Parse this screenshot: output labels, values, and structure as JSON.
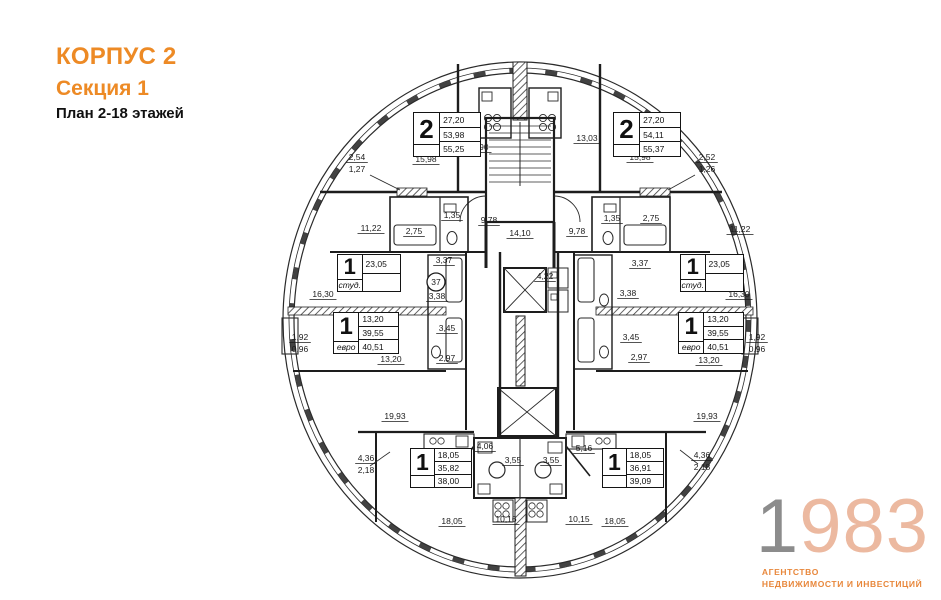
{
  "title": {
    "building": "КОРПУС 2",
    "section": "Секция 1",
    "plan": "План 2-18 этажей"
  },
  "logo": {
    "digit_first": "1",
    "digits_rest": "983",
    "agency_line1": "АГЕНТСТВО",
    "agency_line2": "НЕДВИЖИМОСТИ И ИНВЕСТИЦИЙ"
  },
  "colors": {
    "accent_orange": "#ED8A25",
    "logo_gray": "#8C8C8C",
    "logo_salmon": "#ECB9A0",
    "plan_line": "#1d1d1d"
  },
  "callout": {
    "value": "37"
  },
  "apartments": [
    {
      "id": "apt-2-top-left",
      "number": "2",
      "tag": "",
      "areas": [
        "27,20",
        "53,98",
        "55,25"
      ],
      "x": 413,
      "y": 112,
      "w": 68,
      "h": 45
    },
    {
      "id": "apt-2-top-right",
      "number": "2",
      "tag": "",
      "areas": [
        "27,20",
        "54,11",
        "55,37"
      ],
      "x": 613,
      "y": 112,
      "w": 68,
      "h": 45
    },
    {
      "id": "apt-1-studio-left",
      "number": "1",
      "tag": "студ.",
      "areas": [
        "23,05"
      ],
      "x": 337,
      "y": 254,
      "w": 64,
      "h": 38
    },
    {
      "id": "apt-1-studio-right",
      "number": "1",
      "tag": "студ.",
      "areas": [
        "23,05"
      ],
      "x": 680,
      "y": 254,
      "w": 64,
      "h": 38
    },
    {
      "id": "apt-1-euro-left",
      "number": "1",
      "tag": "евро",
      "areas": [
        "13,20",
        "39,55",
        "40,51"
      ],
      "x": 333,
      "y": 312,
      "w": 66,
      "h": 42
    },
    {
      "id": "apt-1-euro-right",
      "number": "1",
      "tag": "евро",
      "areas": [
        "13,20",
        "39,55",
        "40,51"
      ],
      "x": 678,
      "y": 312,
      "w": 66,
      "h": 42
    },
    {
      "id": "apt-1-bottom-left",
      "number": "1",
      "tag": "",
      "areas": [
        "18,05",
        "35,82",
        "38,00"
      ],
      "x": 410,
      "y": 448,
      "w": 62,
      "h": 40
    },
    {
      "id": "apt-1-bottom-right",
      "number": "1",
      "tag": "",
      "areas": [
        "18,05",
        "36,91",
        "39,09"
      ],
      "x": 602,
      "y": 448,
      "w": 62,
      "h": 40
    }
  ],
  "dimensions": [
    {
      "v": "2,54",
      "v2": "1,27",
      "x": 357,
      "y": 160
    },
    {
      "v": "15,98",
      "x": 426,
      "y": 162
    },
    {
      "v": "12,90",
      "x": 478,
      "y": 150
    },
    {
      "v": "13,03",
      "x": 587,
      "y": 141
    },
    {
      "v": "15,98",
      "x": 640,
      "y": 160
    },
    {
      "v": "2,52",
      "v2": "1,26",
      "x": 707,
      "y": 160
    },
    {
      "v": "11,22",
      "x": 371,
      "y": 231
    },
    {
      "v": "2,75",
      "x": 414,
      "y": 234
    },
    {
      "v": "1,35",
      "x": 452,
      "y": 218
    },
    {
      "v": "9,78",
      "x": 489,
      "y": 223
    },
    {
      "v": "14,10",
      "x": 520,
      "y": 236
    },
    {
      "v": "9,78",
      "x": 577,
      "y": 234
    },
    {
      "v": "1,35",
      "x": 612,
      "y": 221
    },
    {
      "v": "2,75",
      "x": 651,
      "y": 221
    },
    {
      "v": "11,22",
      "x": 740,
      "y": 232
    },
    {
      "v": "3,37",
      "x": 444,
      "y": 263
    },
    {
      "v": "3,38",
      "x": 437,
      "y": 299
    },
    {
      "v": "3,37",
      "x": 640,
      "y": 266
    },
    {
      "v": "3,38",
      "x": 628,
      "y": 296
    },
    {
      "v": "16,30",
      "x": 323,
      "y": 297
    },
    {
      "v": "16,30",
      "x": 739,
      "y": 297
    },
    {
      "v": "1,92",
      "v2": "0,96",
      "x": 300,
      "y": 340
    },
    {
      "v": "1,92",
      "v2": "0,96",
      "x": 757,
      "y": 340
    },
    {
      "v": "3,45",
      "x": 447,
      "y": 331
    },
    {
      "v": "3,45",
      "x": 631,
      "y": 340
    },
    {
      "v": "13,20",
      "x": 391,
      "y": 362
    },
    {
      "v": "2,97",
      "x": 447,
      "y": 361
    },
    {
      "v": "2,97",
      "x": 639,
      "y": 360
    },
    {
      "v": "13,20",
      "x": 709,
      "y": 363
    },
    {
      "v": "4,22",
      "x": 545,
      "y": 279
    },
    {
      "v": "19,93",
      "x": 395,
      "y": 419
    },
    {
      "v": "19,93",
      "x": 707,
      "y": 419
    },
    {
      "v": "4,36",
      "v2": "2,18",
      "x": 366,
      "y": 461
    },
    {
      "v": "4,36",
      "v2": "2,18",
      "x": 702,
      "y": 458
    },
    {
      "v": "4,06",
      "x": 485,
      "y": 449
    },
    {
      "v": "5,16",
      "x": 584,
      "y": 451
    },
    {
      "v": "3,55",
      "x": 513,
      "y": 463
    },
    {
      "v": "3,55",
      "x": 551,
      "y": 463
    },
    {
      "v": "18,05",
      "x": 452,
      "y": 524
    },
    {
      "v": "10,16",
      "x": 506,
      "y": 522
    },
    {
      "v": "10,15",
      "x": 579,
      "y": 522
    },
    {
      "v": "18,05",
      "x": 615,
      "y": 524
    }
  ]
}
